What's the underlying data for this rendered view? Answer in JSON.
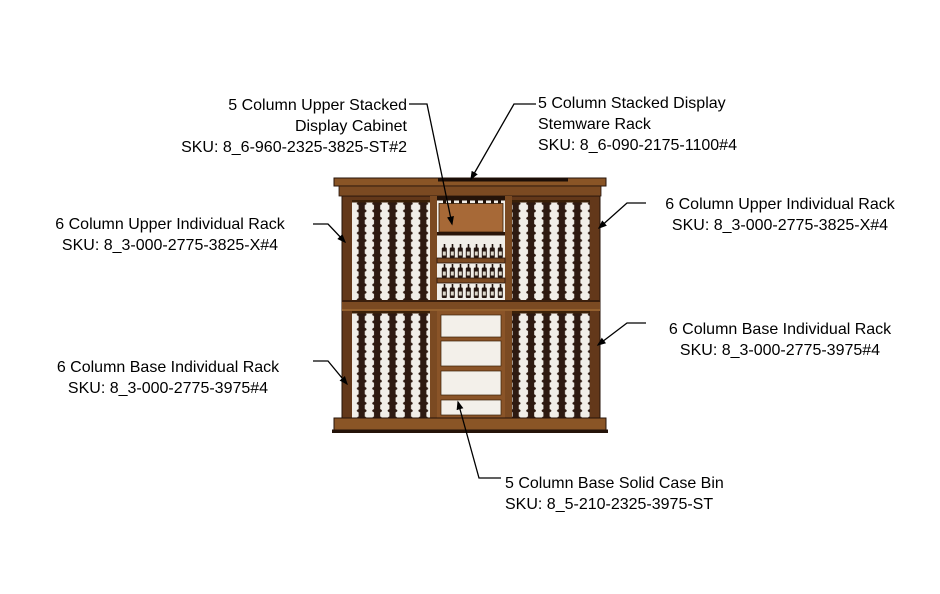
{
  "labels": [
    {
      "name": "upper-stacked-display-cabinet",
      "lines": [
        "5 Column Upper Stacked",
        "Display Cabinet"
      ],
      "sku": "SKU: 8_6-960-2325-3825-ST#2"
    },
    {
      "name": "stacked-display-stemware-rack",
      "lines": [
        "5 Column Stacked Display",
        "Stemware Rack"
      ],
      "sku": "SKU: 8_6-090-2175-1100#4"
    },
    {
      "name": "upper-individual-rack-left",
      "lines": [
        "6 Column Upper Individual Rack"
      ],
      "sku": "SKU: 8_3-000-2775-3825-X#4"
    },
    {
      "name": "upper-individual-rack-right",
      "lines": [
        "6 Column Upper Individual Rack"
      ],
      "sku": "SKU: 8_3-000-2775-3825-X#4"
    },
    {
      "name": "base-individual-rack-right",
      "lines": [
        "6 Column Base Individual Rack"
      ],
      "sku": "SKU: 8_3-000-2775-3975#4"
    },
    {
      "name": "base-individual-rack-left",
      "lines": [
        "6 Column Base Individual Rack"
      ],
      "sku": "SKU: 8_3-000-2775-3975#4"
    },
    {
      "name": "base-solid-case-bin",
      "lines": [
        "5 Column Base Solid Case Bin"
      ],
      "sku": "SKU: 8_5-210-2325-3975-ST"
    }
  ],
  "palette": {
    "page_bg": "#ffffff",
    "line": "#000000",
    "wood_frame": "#63381a",
    "wood_trim": "#8a5526",
    "wood_mid": "#7b4a22",
    "wood_panel": "#a76937",
    "rail_dark": "#2e1a11",
    "rack_bg": "#f1eee8",
    "bin_wood": "#8a5428",
    "shadow": "#241309"
  }
}
